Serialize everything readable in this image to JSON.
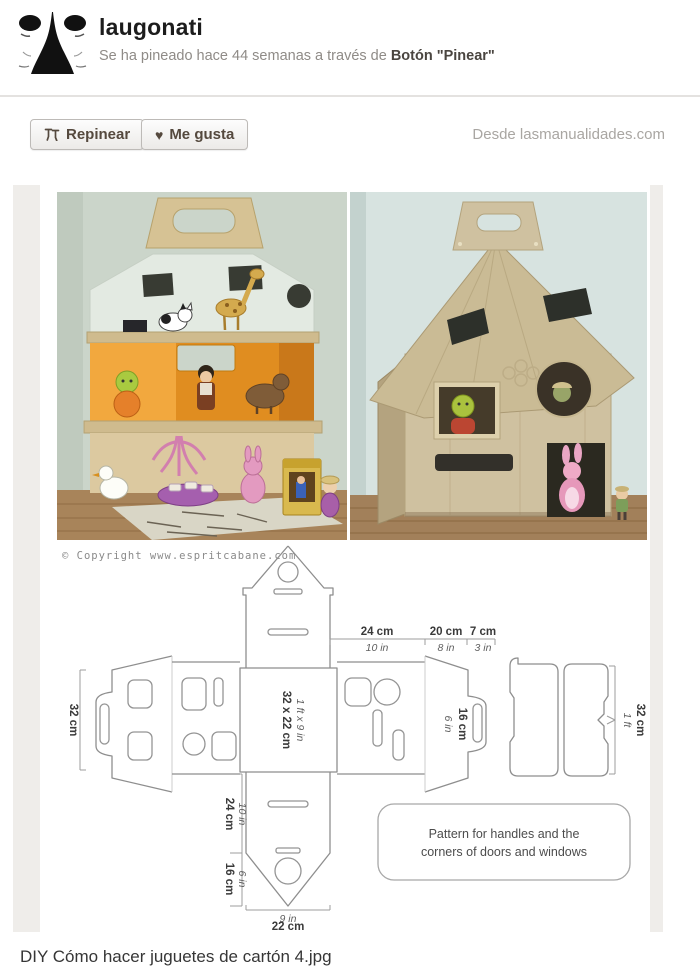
{
  "header": {
    "username": "laugonati",
    "pinned_text": "Se ha pineado hace 44 semanas a través de ",
    "pinned_via_bold": "Botón \"Pinear\""
  },
  "actions": {
    "repin_label": "Repinear",
    "like_label": "Me gusta",
    "like_icon_glyph": "♥",
    "source_label": "Desde lasmanualidades.com"
  },
  "pin_image": {
    "copyright": "© Copyright www.espritcabane.com",
    "pattern": {
      "top_w1_cm": "24 cm",
      "top_w1_in": "10 in",
      "top_w2_cm": "20 cm",
      "top_w2_in": "8 in",
      "top_w3_cm": "7 cm",
      "top_w3_in": "3 in",
      "left_height_cm": "32 cm",
      "center_cm": "32 x 22 cm",
      "center_in": "1 ft x 9 in",
      "gable_in": "6 in",
      "gable_cm": "16 cm",
      "roof_ft": "1 ft",
      "roof_cm": "32 cm",
      "lower1_cm": "24 cm",
      "lower1_in": "10 in",
      "lower2_cm": "16 cm",
      "lower2_in": "6 in",
      "bottom_in": "9 in",
      "bottom_cm": "22 cm",
      "note_line1": "Pattern for handles and the",
      "note_line2": "corners of doors and windows"
    }
  },
  "caption": "DIY Cómo hacer juguetes de cartón 4.jpg",
  "colors": {
    "accent_text": "#55493e",
    "page_gutter": "#efedea",
    "cardboard": "#cfc1a0",
    "orange_interior": "#e08d20"
  }
}
